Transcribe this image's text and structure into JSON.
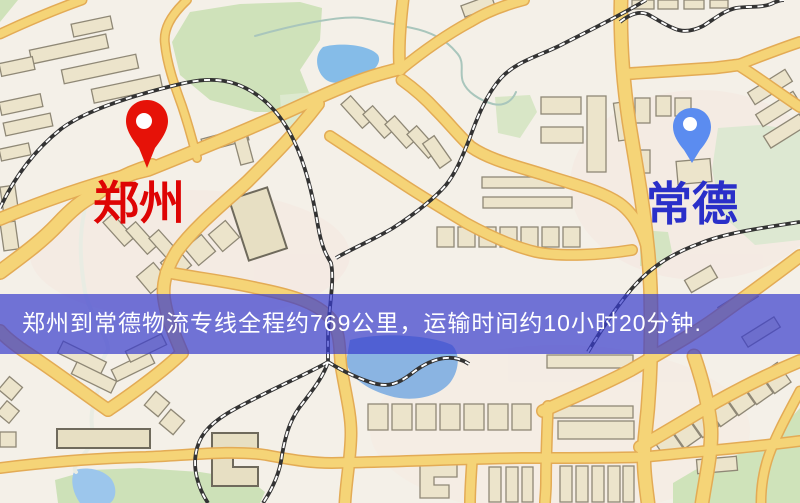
{
  "map": {
    "origin": {
      "name": "郑州",
      "label_color": "#de0404",
      "pin_color": "#e61208",
      "pin_icon": "map-pin"
    },
    "destination": {
      "name": "常德",
      "label_color": "#2a2fc9",
      "pin_color": "#5b8cf0",
      "pin_icon": "map-pin"
    },
    "colors": {
      "background": "#f4f0e8",
      "road_fill": "#f5d477",
      "road_casing": "#e3ab55",
      "railway": "#333333",
      "park": "#cfe2ba",
      "water": "#8ab4e2",
      "building": "#ece4cb"
    }
  },
  "banner": {
    "text": "郑州到常德物流专线全程约769公里，运输时间约10小时20分钟.",
    "bg_color": "#383ccd",
    "text_color": "#ffffff"
  }
}
